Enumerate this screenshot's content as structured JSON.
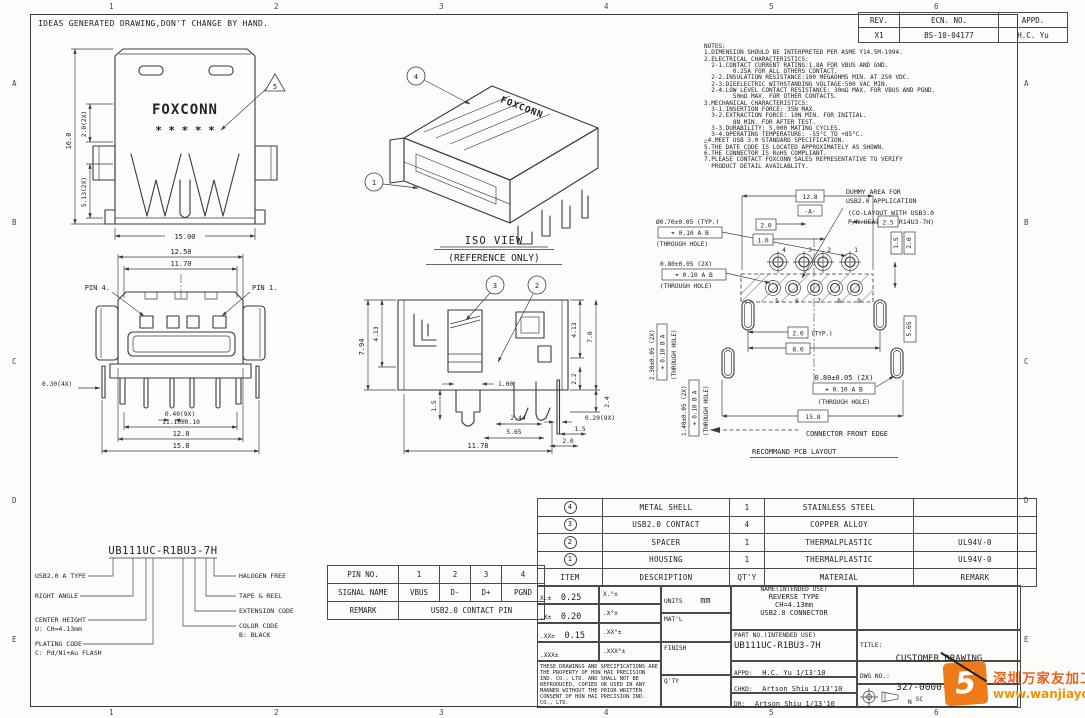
{
  "frame": {
    "header_note": "IDEAS GENERATED DRAWING,DON'T CHANGE BY HAND.",
    "cols": [
      "1",
      "2",
      "3",
      "4",
      "5",
      "6"
    ],
    "rows": [
      "A",
      "B",
      "C",
      "D",
      "E"
    ]
  },
  "rev_table": {
    "headers": [
      "REV.",
      "ECN. NO.",
      "APPD."
    ],
    "row": [
      "X1",
      "BS-10-04177",
      "H.C. Yu"
    ]
  },
  "notes": {
    "lines": [
      "NOTES:",
      "1.DIMENSION SHOULD BE INTERPRETED PER ASME Y14.5M-1994.",
      "2.ELECTRICAL CHARACTERISTICS:",
      "  2-1.CONTACT CURRENT RATING:1.8A FOR VBUS AND GND.",
      "        0.25A FOR ALL OTHERS CONTACT.",
      "  2-2.INSULATION RESISTANCE:100 MEGAOHMS MIN. AT 250 VDC.",
      "  2-3.DIEELECTRIC WITHSTANDING VOLTAGE:500 VAC MIN.",
      "  2-4.LOW LEVEL CONTACT RESISTANCE: 30mΩ MAX. FOR VBUS AND PGND.",
      "        50mΩ MAX. FOR OTHER CONTACTS.",
      "3.MECHANICAL CHARACTERISTICS:",
      "  3-1.INSERTION FORCE: 35N MAX.",
      "  3-2.EXTRACTION FORCE: 10N MIN. FOR INITIAL.",
      "        8N MIN. FOR AFTER TEST.",
      "  3-3.DURABILITY: 5,000 MATING CYCLES.",
      "  3-4.OPERATING TEMPERATURE: -55°C TO +85°C.",
      "△4.MEET USB 3.0 STANDARD SPECIFICATION.",
      "5.THE DATE CODE IS LOCATED APPROXIMATELY AS SHOWN.",
      "6.THE CONNECTOR IS RoHS COMPLIANT.",
      "7.PLEASE CONTACT FOXCONN SALES REPRESENTATIVE TO VERIFY",
      "  PRODUCT DETAIL AVAILABLITY."
    ]
  },
  "views": {
    "top": {
      "logo": "FOXCONN",
      "date_code": "* * * * *",
      "flag": "5",
      "dim_height": "16.0",
      "dim_upper": "2.0(2X)",
      "dim_lower": "5.13(2X)",
      "dim_width": "15.00"
    },
    "iso": {
      "title": "ISO VIEW",
      "subtitle": "(REFERENCE ONLY)",
      "logo": "FOXCONN",
      "balloon_shell": "4",
      "balloon_housing": "1"
    },
    "front": {
      "pin4": "PIN 4.",
      "pin1": "PIN 1.",
      "dim_a": "12.50",
      "dim_b": "11.70",
      "dim_c": "0.30(4X)",
      "dim_d": "0.40(9X)",
      "dim_e": "11.10±0.10",
      "dim_f": "12.8",
      "dim_g": "15.8"
    },
    "side": {
      "balloon_contact": "3",
      "balloon_spacer": "2",
      "dim_a": "7.94",
      "dim_b": "4.13",
      "dim_c": "1.00",
      "dim_d": "1.5",
      "dim_e": "2.44",
      "dim_f": "5.65",
      "dim_g": "11.78",
      "dim_h": "7.0",
      "dim_i": "4.13",
      "dim_j": "2.2",
      "dim_k": "2.4",
      "dim_l": "0.20(9X)",
      "dim_m": "1.5",
      "dim_n": "2.0"
    },
    "pcb": {
      "note1": "DUMMY AREA FOR",
      "note2": "USB2.0 APPLICATION",
      "note3": "(CO-LAYOUT WITH USB3.0",
      "note4": "P/N:UEA111UC-R14U3-7H)",
      "hole1": "Ø0.70±0.05 (TYP.)",
      "hole1_fcf": "⌖ 0.10 A B",
      "hole2": "0.80±0.05 (2X)",
      "hole2_fcf": "⌖ 0.10 A B",
      "slot1": "2.30±0.05 (2X)",
      "slot1_fcf": "⌖ 0.10 B A",
      "slot2": "1.40±0.05 (2X)",
      "slot2_fcf": "⌖ 0.10 B A",
      "hole3": "0.80±0.05 (2X)",
      "hole3_fcf": "⌖ 0.10 A B",
      "through_hole": "(THROUGH HOLE)",
      "dim_a": "12.8",
      "datum": "-A-",
      "dim_b": "2.0",
      "dim_c": "1.0",
      "dim_d": "2.5",
      "dim_e": "1.5",
      "dim_f": "2.0",
      "dim_g": "5.65",
      "dim_h": "2.0",
      "typ": "(TYP.)",
      "dim_i": "8.0",
      "dim_j": "15.8",
      "front_edge": "CONNECTOR FRONT EDGE",
      "caption": "RECOMMAND PCB LAYOUT",
      "pins_top": [
        "4",
        "3",
        "2",
        "1"
      ],
      "pins_bottom": [
        "5",
        "6",
        "7",
        "8",
        "9"
      ]
    }
  },
  "part_breakdown": {
    "value": "UB111UC-R1BU3-7H",
    "left": [
      [
        "USB2.0 A TYPE",
        ""
      ],
      [
        "RIGHT ANGLE",
        ""
      ],
      [
        "CENTER HEIGHT",
        "U: CH=4.13mm"
      ],
      [
        "PLATING CODE",
        "C: Pd/Ni+Au FLASH"
      ]
    ],
    "right": [
      [
        "HALOGEN FREE",
        ""
      ],
      [
        "TAPE & REEL",
        ""
      ],
      [
        "EXTENSION CODE",
        ""
      ],
      [
        "COLOR CODE",
        "B: BLACK"
      ]
    ]
  },
  "pin_table": {
    "r0": [
      "PIN NO.",
      "1",
      "2",
      "3",
      "4"
    ],
    "r1": [
      "SIGNAL NAME",
      "VBUS",
      "D-",
      "D+",
      "PGND"
    ],
    "r2": [
      "REMARK",
      "USB2.0 CONTACT PIN"
    ]
  },
  "bom": {
    "headers": [
      "ITEM",
      "DESCRIPTION",
      "QT'Y",
      "MATERIAL",
      "REMARK"
    ],
    "rows": [
      {
        "item": "4",
        "desc": "METAL SHELL",
        "qty": "1",
        "material": "STAINLESS STEEL",
        "remark": ""
      },
      {
        "item": "3",
        "desc": "USB2.0 CONTACT",
        "qty": "4",
        "material": "COPPER ALLOY",
        "remark": ""
      },
      {
        "item": "2",
        "desc": "SPACER",
        "qty": "1",
        "material": "THERMALPLASTIC",
        "remark": "UL94V-0"
      },
      {
        "item": "1",
        "desc": "HOUSING",
        "qty": "1",
        "material": "THERMALPLASTIC",
        "remark": "UL94V-0"
      }
    ]
  },
  "title_block": {
    "tol_rows": [
      [
        "X.±",
        "0.25",
        "X.°±"
      ],
      [
        ".X±",
        "0.20",
        ".X°±"
      ],
      [
        ".XX±",
        "0.15",
        ".XX°±"
      ],
      [
        ".XXX±",
        "",
        ".XXX°±"
      ]
    ],
    "property_note": "THESE DRAWINGS AND SPECIFICATIONS ARE THE PROPERTY OF HON HAI PRECISION IND. CO., LTD. AND SHALL NOT BE REPRODUCED, COPIED OR USED IN ANY MANNER WITHOUT THE PRIOR WRITTEN CONSENT OF HON HAI PRECISION IND. CO., LTD.",
    "units_label": "UNITS",
    "units_value": "mm",
    "matl_label": "MAT'L",
    "finish_label": "FINISH",
    "qty_label": "Q'TY",
    "name_label": "NAME(INTENDED USE)",
    "name_line1": "REVERSE TYPE",
    "name_line2": "CH=4.13mm",
    "name_line3": "USB2.0 CONNECTOR",
    "part_label": "PART NO.(INTENDED USE)",
    "part_value": "UB111UC-R1BU3-7H",
    "appd_label": "APPD:",
    "appd_value": "H.C. Yu 1/13'10",
    "chkd_label": "CHKD:",
    "chkd_value": "Artson Shiu 1/13'10",
    "dr_label": "DR:",
    "dr_value": "Artson Shiu 1/13'10",
    "title_label": "TITLE:",
    "title_value": "CUSTOMER DRAWING",
    "dwg_label": "DWG NO.:",
    "dwg_value": "327-0000-2R14U3",
    "scale_text": "SC",
    "sheet_text": "N"
  },
  "watermark": {
    "logo_glyph": "5",
    "line1": "深圳万家友加工网",
    "line2": "www.wanjiayou.com"
  }
}
